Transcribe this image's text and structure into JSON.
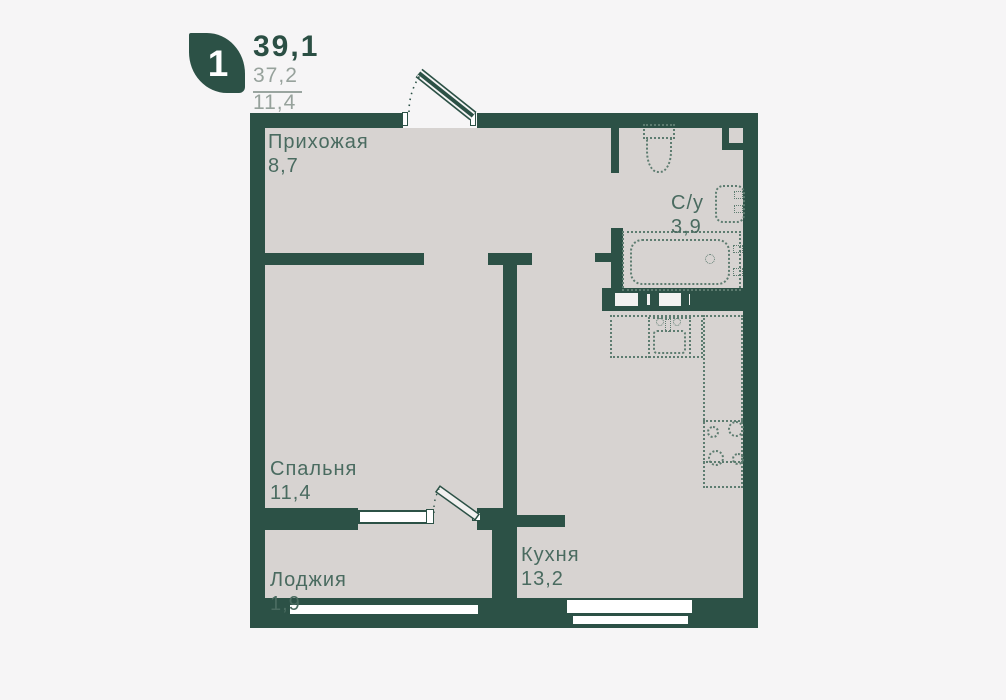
{
  "header": {
    "rooms_badge": "1",
    "area_total": "39,1",
    "area_living": "37,2",
    "area_kitchen": "11,4"
  },
  "rooms": [
    {
      "id": "hallway",
      "label": "Прихожая",
      "area": "8,7"
    },
    {
      "id": "bathroom",
      "label": "С/у",
      "area": "3,9"
    },
    {
      "id": "bedroom",
      "label": "Спальня",
      "area": "11,4"
    },
    {
      "id": "loggia",
      "label": "Лоджия",
      "area": "1,9"
    },
    {
      "id": "kitchen",
      "label": "Кухня",
      "area": "13,2"
    }
  ],
  "icons": [
    "toilet-icon",
    "washbasin-icon",
    "bathtub-icon",
    "kitchen-sink-icon",
    "stove-icon",
    "kitchen-counter-icon",
    "entrance-door-icon",
    "loggia-door-icon",
    "window-icon"
  ],
  "colors": {
    "wall": "#2c5146",
    "floor": "#d7d3d1",
    "background": "#f6f5f6",
    "fixture": "#5d7c70",
    "label": "#4a6b60",
    "secondary_text": "#97a29c"
  }
}
